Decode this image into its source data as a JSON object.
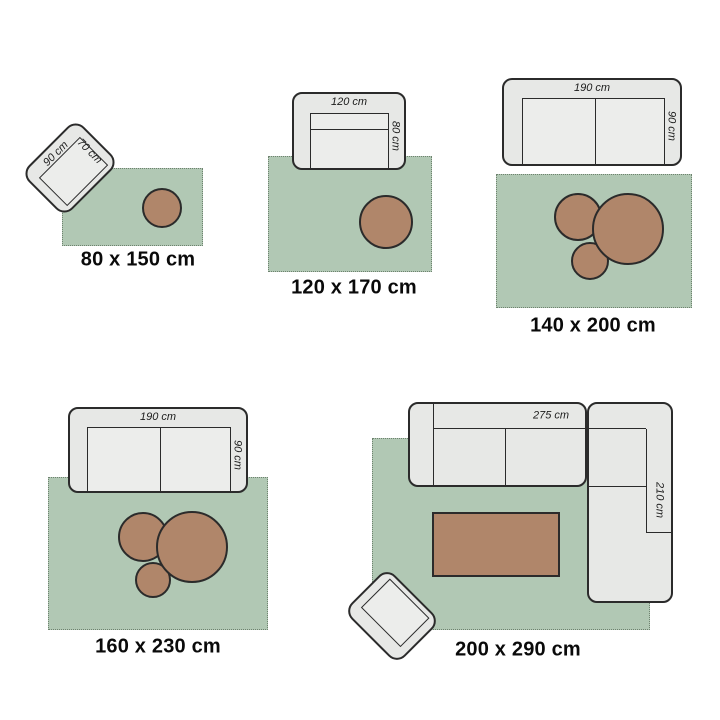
{
  "panels": [
    {
      "size_label": "80 x 150 cm",
      "furniture": {
        "type": "armchair-rotated",
        "width_label": "90 cm",
        "depth_label": "70 cm"
      },
      "decor": [
        "round-pouf"
      ]
    },
    {
      "size_label": "120 x 170 cm",
      "furniture": {
        "type": "armchair",
        "width_label": "120 cm",
        "depth_label": "80 cm"
      },
      "decor": [
        "round-pouf"
      ]
    },
    {
      "size_label": "140 x 200 cm",
      "furniture": {
        "type": "two-seater-sofa",
        "width_label": "190 cm",
        "depth_label": "90 cm"
      },
      "decor": [
        "round-pouf-medium",
        "round-pouf-small",
        "round-pouf-large"
      ]
    },
    {
      "size_label": "160 x 230 cm",
      "furniture": {
        "type": "two-seater-sofa",
        "width_label": "190 cm",
        "depth_label": "90 cm"
      },
      "decor": [
        "round-pouf-medium",
        "round-pouf-small",
        "round-pouf-large"
      ]
    },
    {
      "size_label": "200 x 290 cm",
      "furniture": {
        "type": "corner-sofa",
        "width_label": "275 cm",
        "depth_label": "210 cm"
      },
      "decor": [
        "coffee-table",
        "armchair-rotated"
      ]
    }
  ],
  "colors": {
    "background": "#ffffff",
    "rug": "#b1c8b4",
    "rug_fringe": "#6e826f",
    "furniture_fill": "#e7e8e6",
    "furniture_seat_fill": "#ecedeb",
    "outline": "#2b2b2b",
    "accent_brown": "#b0866a",
    "label_text": "#0a0a0a"
  }
}
